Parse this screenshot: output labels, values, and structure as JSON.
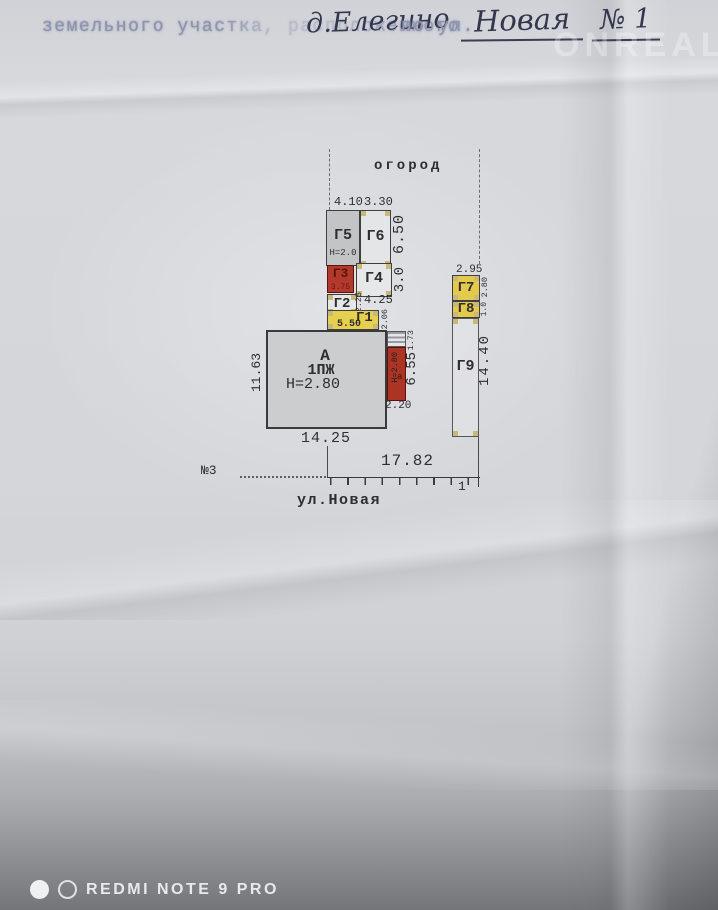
{
  "header": {
    "stamped_prefix": "земельного участка, расположенного",
    "handwritten_place": "д.Елегино",
    "stamped_street_label": "по ул.",
    "handwritten_street": "Новая",
    "handwritten_number": "№ 1"
  },
  "plan": {
    "garden_label": "огород",
    "street_name": "ул.Новая",
    "neighbor_label": "№3",
    "street_corner_mark": "1",
    "house": {
      "letter": "А",
      "type": "1ПЖ",
      "height": "Н=2.80"
    },
    "annex": {
      "height": "Н=2.80",
      "letter": "а"
    },
    "buildings": {
      "g1": "Г1",
      "g2": "Г2",
      "g3": "Г3",
      "g4": "Г4",
      "g5": "Г5",
      "g6": "Г6",
      "g7": "Г7",
      "g8": "Г8",
      "g9": "Г9"
    },
    "g5_height": "Н=2.0",
    "g3_size": "3.75",
    "dims": {
      "d410": "4.10",
      "d330": "3.30",
      "d650": "6.50",
      "d30": "3.0",
      "d225": "2.25",
      "d425": "4.25",
      "d550": "5.50",
      "d206": "2.06",
      "d1163": "11.63",
      "d1425": "14.25",
      "d173": "1.73",
      "d655": "6.55",
      "d220": "2.20",
      "d295": "2.95",
      "d280": "2.80",
      "d10": "1.0",
      "d1440": "14.40",
      "d1782": "17.82"
    },
    "colors": {
      "wood_yellow": "#e6d04d",
      "brick_red": "#b13a2c",
      "stone_gray": "#c3c4c6",
      "marker_tan": "#c8b97b"
    }
  },
  "watermarks": {
    "site": "ONREALT",
    "camera_brand": "REDMI NOTE 9 PRO"
  }
}
